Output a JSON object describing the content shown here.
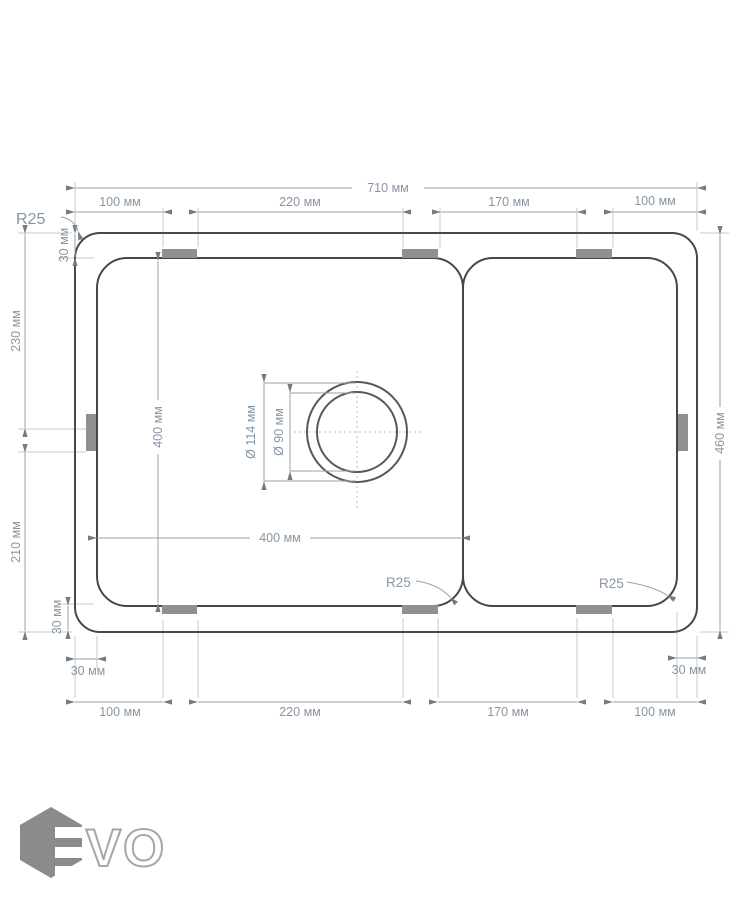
{
  "drawing": {
    "units": "мм",
    "dims": {
      "overall_width": "710 мм",
      "top_100_left": "100 мм",
      "top_220": "220 мм",
      "top_170": "170 мм",
      "top_100_right": "100 мм",
      "left_30_top": "30 мм",
      "left_230": "230 мм",
      "left_210": "210 мм",
      "left_30_bottom": "30 мм",
      "bowl_height": "400 мм",
      "bowl_width": "400 мм",
      "drain_outer_diameter": "Ø 114 мм",
      "drain_inner_diameter": "Ø 90 мм",
      "right_height": "460 мм",
      "bottom_30_left": "30 мм",
      "bottom_30_right": "30 мм",
      "bottom_100_left": "100 мм",
      "bottom_220": "220 мм",
      "bottom_170": "170 мм",
      "bottom_100_right": "100 мм",
      "radius_top_left": "R25",
      "radius_bowl": "R25",
      "radius_board": "R25"
    },
    "colors": {
      "outline": "#474747",
      "dimension_line": "#97a0a7",
      "extension_line": "#c4c9ce",
      "dimension_text": "#8795a3",
      "mounting_tab": "#8f9092",
      "logo_gray": "#8b8b8b"
    }
  },
  "logo": {
    "text": "VO"
  }
}
